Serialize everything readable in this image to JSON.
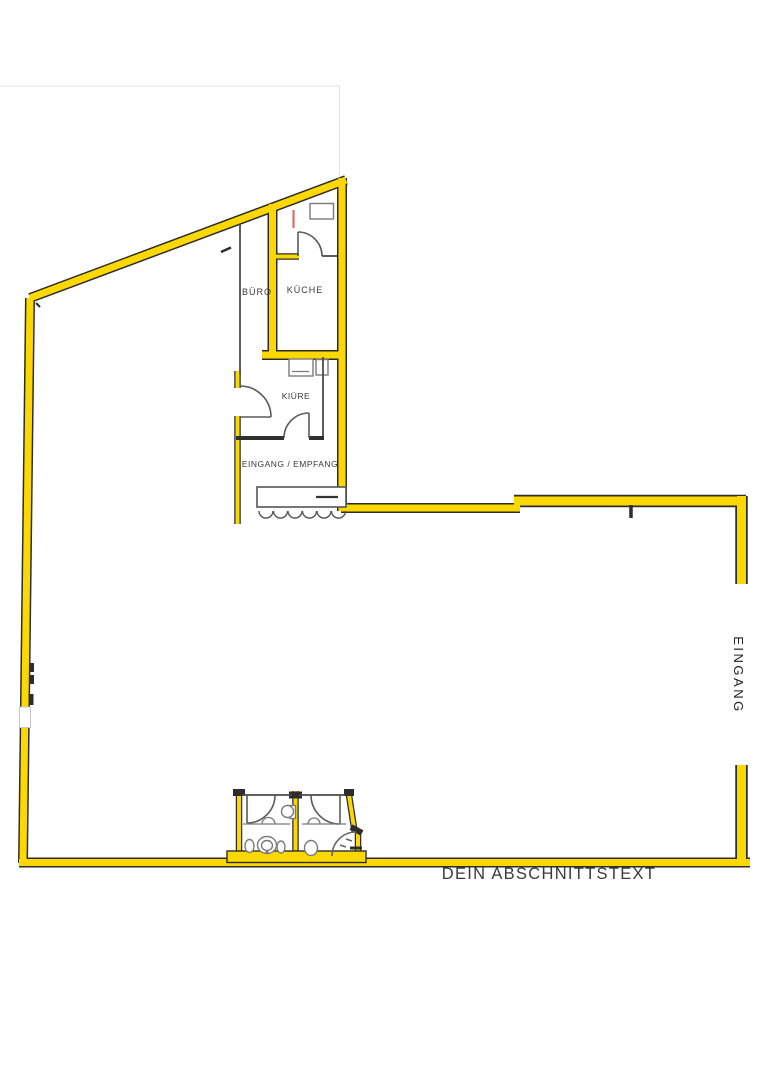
{
  "plan": {
    "rooms": [
      {
        "id": "buero",
        "label": "BÜRO"
      },
      {
        "id": "kueche",
        "label": "KÜCHE"
      },
      {
        "id": "kiure",
        "label": "KIÜRE"
      },
      {
        "id": "eingang_empfang",
        "label": "EINGANG / EMPFANG"
      }
    ],
    "entrance_label": "EINGANG",
    "section_label": "DEIN ABSCHNITTSTEXT",
    "colors": {
      "wall_fill": "#fcd803",
      "wall_edge": "#2d2d2d",
      "interior_line": "#5a5a5a",
      "marker_red": "#e46a6a",
      "label_text": "#3a3a3a"
    }
  }
}
